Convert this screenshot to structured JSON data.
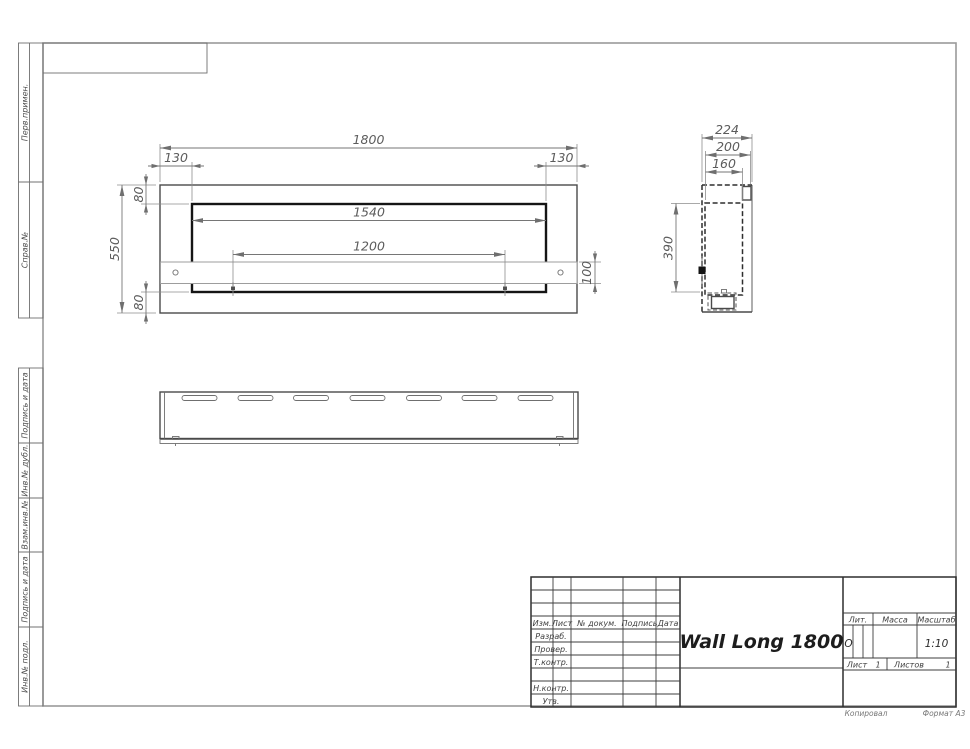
{
  "front_view": {
    "dim_overall_width": "1800",
    "dim_left_offset": "130",
    "dim_right_offset": "130",
    "dim_top_flange": "80",
    "dim_bottom_flange": "80",
    "dim_overall_height": "550",
    "dim_opening_width": "1540",
    "dim_mount_spacing": "1200",
    "dim_bracket_height": "100"
  },
  "side_view": {
    "dim_overall_depth": "224",
    "dim_inner_depth": "200",
    "dim_body_depth": "160",
    "dim_body_height": "390"
  },
  "margin_column": {
    "perv_primen": "Перв.примен.",
    "sprav_no": "Справ.№",
    "podpis_i_data_upper": "Подпись и дата",
    "inv_no_dubl": "Инв.№ дубл.",
    "vzam_inv_no": "Взам.инв.№",
    "podpis_i_data_lower": "Подпись и дата",
    "inv_no_podl": "Инв.№ подл."
  },
  "title_block": {
    "title": "Wall Long 1800",
    "col_izm": "Изм.",
    "col_list": "Лист",
    "col_no_dokum": "№ докум.",
    "col_podpis": "Подпись",
    "col_data": "Дата",
    "row_razrab": "Разраб.",
    "row_prover": "Провер.",
    "row_t_kontr": "Т.контр.",
    "row_n_kontr": "Н.контр.",
    "row_utv": "Утв.",
    "lit_label": "Лит.",
    "lit_value": "О",
    "massa_label": "Масса",
    "masshtab_label": "Масштаб",
    "masshtab_value": "1:10",
    "list_label": "Лист",
    "list_value": "1",
    "listov_label": "Листов",
    "listov_value": "1"
  },
  "footer": {
    "kopiroval": "Копировал",
    "format": "Формат А3"
  }
}
